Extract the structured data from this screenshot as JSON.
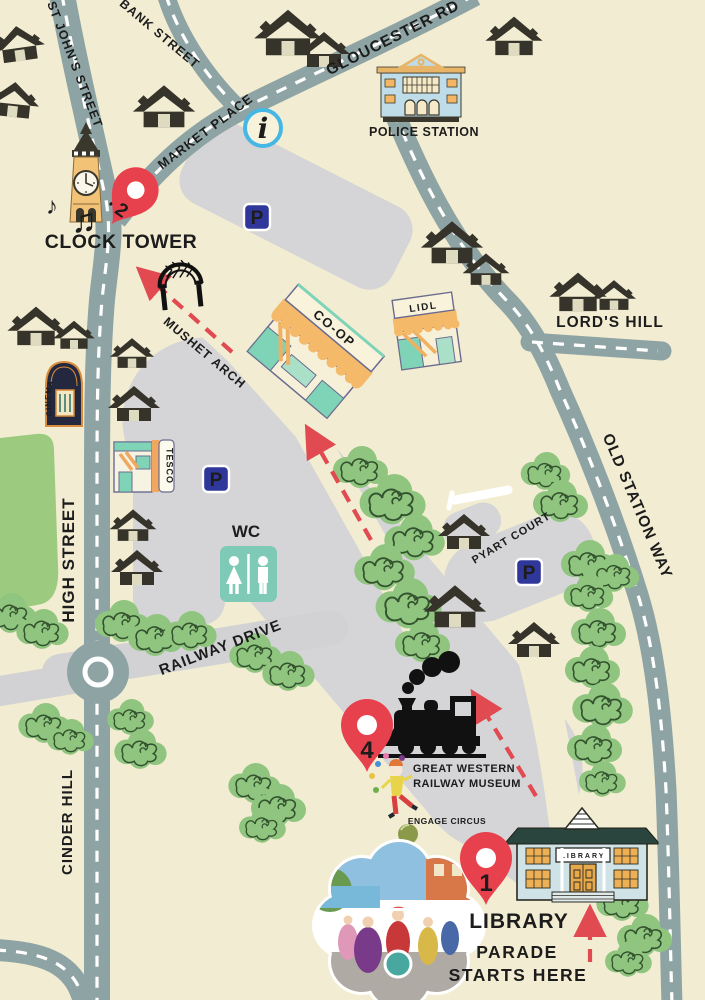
{
  "map": {
    "colors": {
      "background": "#f2edd2",
      "road": "#8ea3a4",
      "road_dash": "#ffffff",
      "parking_area": "#d5d4d6",
      "light_road": "#d2d1d4",
      "tree_green": "#8fc57f",
      "park_green": "#9ccb7f",
      "house_dark": "#35332a",
      "pin_red": "#e8414e",
      "route_red": "#e04a50",
      "callout_red": "#e45454",
      "parking_sign_blue": "#30379b",
      "info_blue": "#45b7e5",
      "wc_teal": "#7ecab6"
    },
    "streets": {
      "bank": "BANK STREET",
      "st_johns": "ST JOHN'S STREET",
      "gloucester": "GLOUCESTER RD",
      "market": "MARKET PLACE",
      "mushet": "MUSHET ARCH",
      "lords_hill": "LORD'S HILL",
      "old_station": "OLD STATION WAY",
      "high": "HIGH STREET",
      "railway": "RAILWAY DRIVE",
      "cinder": "CINDER HILL",
      "pyart": "PYART COURT"
    },
    "pois": {
      "clock_tower": "CLOCK TOWER",
      "police": "POLICE STATION",
      "coop": "CO-OP",
      "lidl": "LIDL",
      "tesco": "TESCO",
      "cinema": "CINEMA",
      "wc": "WC",
      "museum_line1": "GREAT WESTERN",
      "museum_line2": "RAILWAY MUSEUM",
      "engage": "ENGAGE CIRCUS",
      "library_label": "LIBRARY",
      "library_sign": "LIBRARY"
    },
    "markers": {
      "pin1": "1",
      "pin2": "2",
      "pin4": "4",
      "parking": "P",
      "info": "i"
    },
    "icons": {
      "music_note": "♪",
      "music_notes_beamed": "♫"
    },
    "callout": {
      "line1": "PARADE",
      "line2": "STARTS HERE"
    }
  }
}
